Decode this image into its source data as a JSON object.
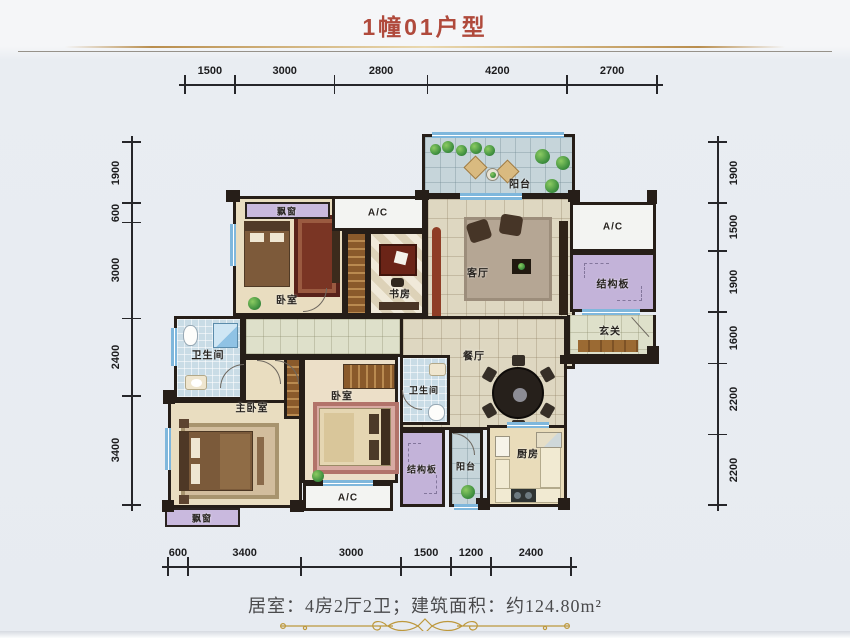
{
  "title": "1幢01户型",
  "summary": "居室：4房2厅2卫；建筑面积：约124.80m²",
  "dimensions": {
    "top": [
      "1500",
      "3000",
      "2800",
      "4200",
      "2700"
    ],
    "bottom": [
      "600",
      "3400",
      "3000",
      "1500",
      "1200",
      "2400"
    ],
    "left": [
      "1900",
      "600",
      "3000",
      "2400",
      "3400"
    ],
    "right": [
      "1900",
      "1500",
      "1900",
      "1600",
      "2200",
      "2200"
    ]
  },
  "rooms": {
    "balcony_top": "阳台",
    "bay_window_top": "飘窗",
    "ac_top_center": "A/C",
    "bedroom1": "卧室",
    "study": "书房",
    "living": "客厅",
    "ac_top_right": "A/C",
    "slab_right": "结构板",
    "entry": "玄关",
    "dining": "餐厅",
    "bath1": "卫生间",
    "master": "主卧室",
    "bedroom2": "卧室",
    "bath2": "卫生间",
    "slab_bottom": "结构板",
    "balcony_bottom": "阳台",
    "kitchen": "厨房",
    "ac_bottom": "A/C",
    "bay_window_bottom": "飘窗"
  }
}
